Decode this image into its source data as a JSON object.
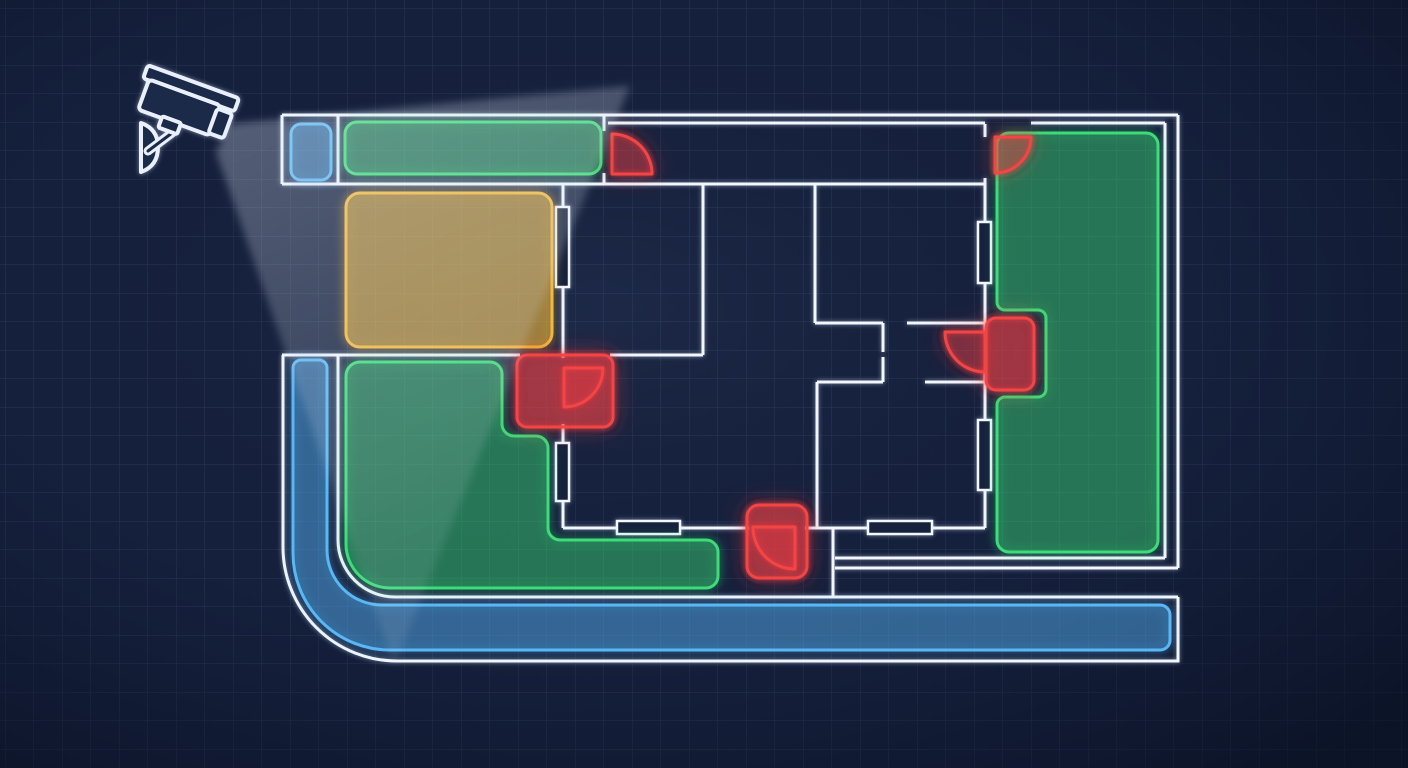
{
  "meta": {
    "width": 1408,
    "height": 768,
    "kind": "security-floorplan-blueprint"
  },
  "palette": {
    "bg": "#15203c",
    "grid_line": "rgba(150,178,232,0.15)",
    "wall": "#f2f6fd",
    "window_fill": "#15203c",
    "camera_fill": "#1b2a4a",
    "camera_stroke": "#e9effb",
    "beam_color": "#e4ecfa",
    "zone": {
      "green": {
        "stroke": "#3ddc78",
        "fill": "rgba(62,215,120,0.30)",
        "glow": "#2ee06e"
      },
      "blue": {
        "stroke": "#58b7f4",
        "fill": "rgba(82,172,238,0.32)",
        "glow": "#57b6f5"
      },
      "yellow": {
        "stroke": "#f2b838",
        "fill": "rgba(240,185,60,0.42)",
        "glow": "#f5b52e"
      },
      "red": {
        "stroke": "#f44545",
        "fill": "rgba(225,62,72,0.30)",
        "glow": "#ff4040"
      }
    }
  },
  "grid": {
    "size": 28.5,
    "offset_x": 5,
    "offset_y": 8
  },
  "camera": {
    "angle": 20,
    "pivot": [
      183,
      112
    ],
    "visor": [
      134,
      80,
      97,
      14,
      3
    ],
    "body": [
      140,
      93,
      76,
      32,
      4
    ],
    "lens": [
      214,
      97,
      16,
      26,
      3
    ],
    "mount": [
      165,
      123,
      20,
      12,
      2
    ],
    "arm": "M172,133 L148,151",
    "plate": "M141,123 L141,172 Q158,166 158,147 Q158,129 141,123 Z",
    "beam_points": "230,124 630,86 394,666 216,152"
  },
  "floorplan": {
    "h_walls": [
      [
        115,
        282,
        1178
      ],
      [
        123,
        608,
        985
      ],
      [
        123,
        1031,
        1165
      ],
      [
        184,
        282,
        985
      ],
      [
        323,
        815,
        883
      ],
      [
        323,
        907,
        985
      ],
      [
        355,
        282,
        520
      ],
      [
        355,
        610,
        703
      ],
      [
        382,
        817,
        883
      ],
      [
        382,
        925,
        985
      ],
      [
        528,
        563,
        749
      ],
      [
        528,
        805,
        985
      ],
      [
        558,
        835,
        1165
      ],
      [
        568,
        835,
        1178
      ]
    ],
    "v_walls": [
      [
        282,
        115,
        184
      ],
      [
        338,
        115,
        184
      ],
      [
        604,
        115,
        131
      ],
      [
        604,
        173,
        184
      ],
      [
        563,
        184,
        207
      ],
      [
        563,
        287,
        358
      ],
      [
        563,
        424,
        443
      ],
      [
        563,
        500,
        528
      ],
      [
        703,
        184,
        355
      ],
      [
        815,
        184,
        323
      ],
      [
        883,
        323,
        352
      ],
      [
        883,
        357,
        382
      ],
      [
        817,
        382,
        528
      ],
      [
        833,
        528,
        597
      ],
      [
        985,
        124,
        137
      ],
      [
        985,
        178,
        222
      ],
      [
        985,
        283,
        332
      ],
      [
        985,
        372,
        420
      ],
      [
        985,
        490,
        528
      ],
      [
        1165,
        123,
        558
      ],
      [
        1178,
        115,
        568
      ]
    ],
    "wall_paths": [
      "M283,355 L283,547 A114,114 0 0 0 397,661 L1178,661 L1178,597",
      "M338,355 L338,540 A57,57 0 0 0 395,597 L1178,597"
    ],
    "windows": [
      [
        556,
        207,
        13,
        80
      ],
      [
        556,
        443,
        13,
        58
      ],
      [
        617,
        521,
        63,
        13
      ],
      [
        868,
        521,
        64,
        13
      ],
      [
        978,
        222,
        13,
        61
      ],
      [
        978,
        420,
        13,
        70
      ]
    ]
  },
  "zones": [
    {
      "id": "zone-entry-closet",
      "color": "blue",
      "shape": "rect",
      "x": 291,
      "y": 124,
      "w": 40,
      "h": 56,
      "r": 10
    },
    {
      "id": "zone-top-hallway",
      "color": "green",
      "shape": "rect",
      "x": 345,
      "y": 122,
      "w": 256,
      "h": 52,
      "r": 12
    },
    {
      "id": "zone-storage-room",
      "color": "yellow",
      "shape": "rect",
      "x": 346,
      "y": 193,
      "w": 206,
      "h": 154,
      "r": 14
    },
    {
      "id": "zone-living-area",
      "color": "green",
      "shape": "path",
      "d": "M360,362 L490,362 A12,12 0 0 1 502,374 L502,424 A12,12 0 0 0 514,436 L536,436 A12,12 0 0 1 548,448 L548,528 A12,12 0 0 0 560,540 L706,540 A12,12 0 0 1 718,552 L718,576 A12,12 0 0 1 706,588 L390,588 A44,44 0 0 1 346,544 L346,376 A14,14 0 0 1 360,362 Z"
    },
    {
      "id": "zone-right-room",
      "color": "green",
      "shape": "path",
      "d": "M1009,133 L1146,133 A12,12 0 0 1 1158,145 L1158,540 A12,12 0 0 1 1146,552 L1009,552 A12,12 0 0 1 997,540 L997,405 A8,8 0 0 1 1005,397 L1038,397 A8,8 0 0 0 1046,389 L1046,318 A8,8 0 0 0 1038,310 L1005,310 A8,8 0 0 1 997,302 L997,145 A12,12 0 0 1 1009,133 Z"
    },
    {
      "id": "zone-perimeter-corridor",
      "color": "blue",
      "shape": "path",
      "d": "M301,360 L319,360 A8,8 0 0 1 327,368 L327,550 A55,55 0 0 0 382,605 L1160,605 A10,10 0 0 1 1170,615 L1170,640 A10,10 0 0 1 1160,650 L390,650 A97,97 0 0 1 293,553 L293,368 A8,8 0 0 1 301,360 Z"
    }
  ],
  "doors": [
    {
      "id": "door-top-left",
      "swing": "M612,174 L612,134 A40,40 0 0 1 652,174 Z"
    },
    {
      "id": "door-top-right",
      "swing": "M995,137 L1031,137 A36,36 0 0 1 995,173 Z"
    },
    {
      "id": "door-inner-left",
      "pad": [
        517,
        355,
        96,
        72,
        10
      ],
      "swing": "M564,368 L603,368 A39,39 0 0 1 564,407 Z"
    },
    {
      "id": "door-inner-right",
      "pad": [
        986,
        318,
        48,
        72,
        10
      ],
      "swing": "M985,332 L945,332 A40,40 0 0 0 985,372 Z"
    },
    {
      "id": "door-bottom",
      "pad": [
        747,
        505,
        60,
        73,
        12
      ],
      "swing": "M795,527 L753,527 A42,42 0 0 0 795,569 Z"
    }
  ]
}
